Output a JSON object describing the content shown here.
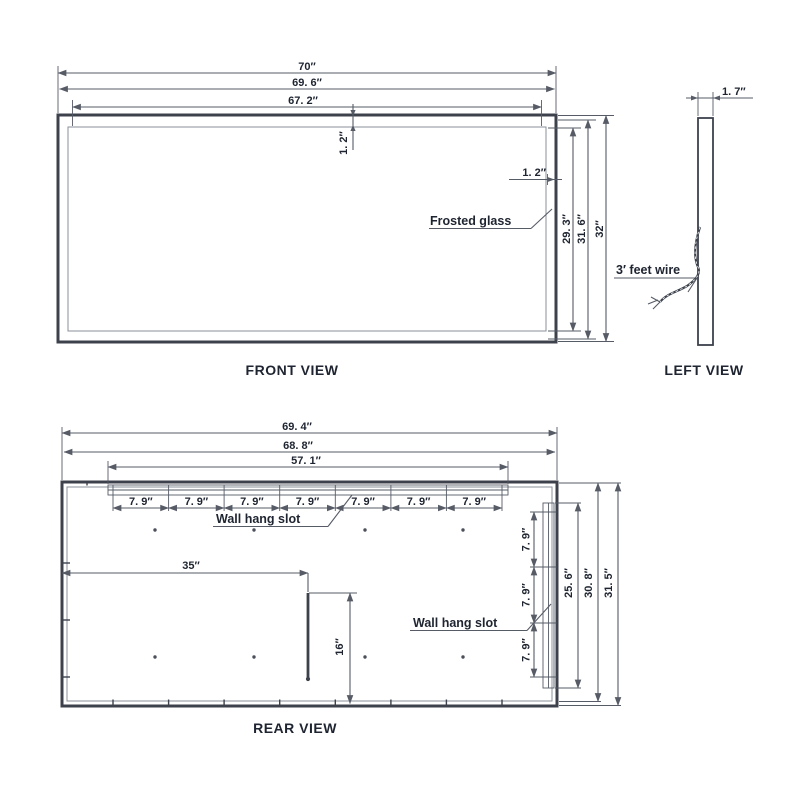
{
  "front_view": {
    "title": "FRONT VIEW",
    "dim_total_width": "70″",
    "dim_frame_width": "69. 6″",
    "dim_glass_width": "67. 2″",
    "dim_border_top": "1. 2″",
    "dim_border_right": "1. 2″",
    "dim_glass_height": "29. 3″",
    "dim_frame_height": "31. 6″",
    "dim_total_height": "32″",
    "glass_label": "Frosted glass"
  },
  "left_view": {
    "title": "LEFT VIEW",
    "dim_depth": "1. 7″",
    "wire_label": "3′ feet wire"
  },
  "rear_view": {
    "title": "REAR VIEW",
    "dim_total_width": "69. 4″",
    "dim_inner_width": "68. 8″",
    "dim_rail_width": "57. 1″",
    "slot_spacing_top": [
      "7. 9″",
      "7. 9″",
      "7. 9″",
      "7. 9″",
      "7. 9″",
      "7. 9″",
      "7. 9″"
    ],
    "slot_spacing_right": [
      "7. 9″",
      "7. 9″",
      "7. 9″"
    ],
    "top_slot_label": "Wall hang slot",
    "right_slot_label": "Wall hang slot",
    "dim_wire_offset": "35″",
    "dim_wire_slot": "16″",
    "dim_rail_height": "25. 6″",
    "dim_inner_height": "30. 8″",
    "dim_total_height": "31. 5″"
  },
  "colors": {
    "line": "#565b66",
    "frame": "#3c414c",
    "text": "#1e2430",
    "background": "#ffffff"
  }
}
